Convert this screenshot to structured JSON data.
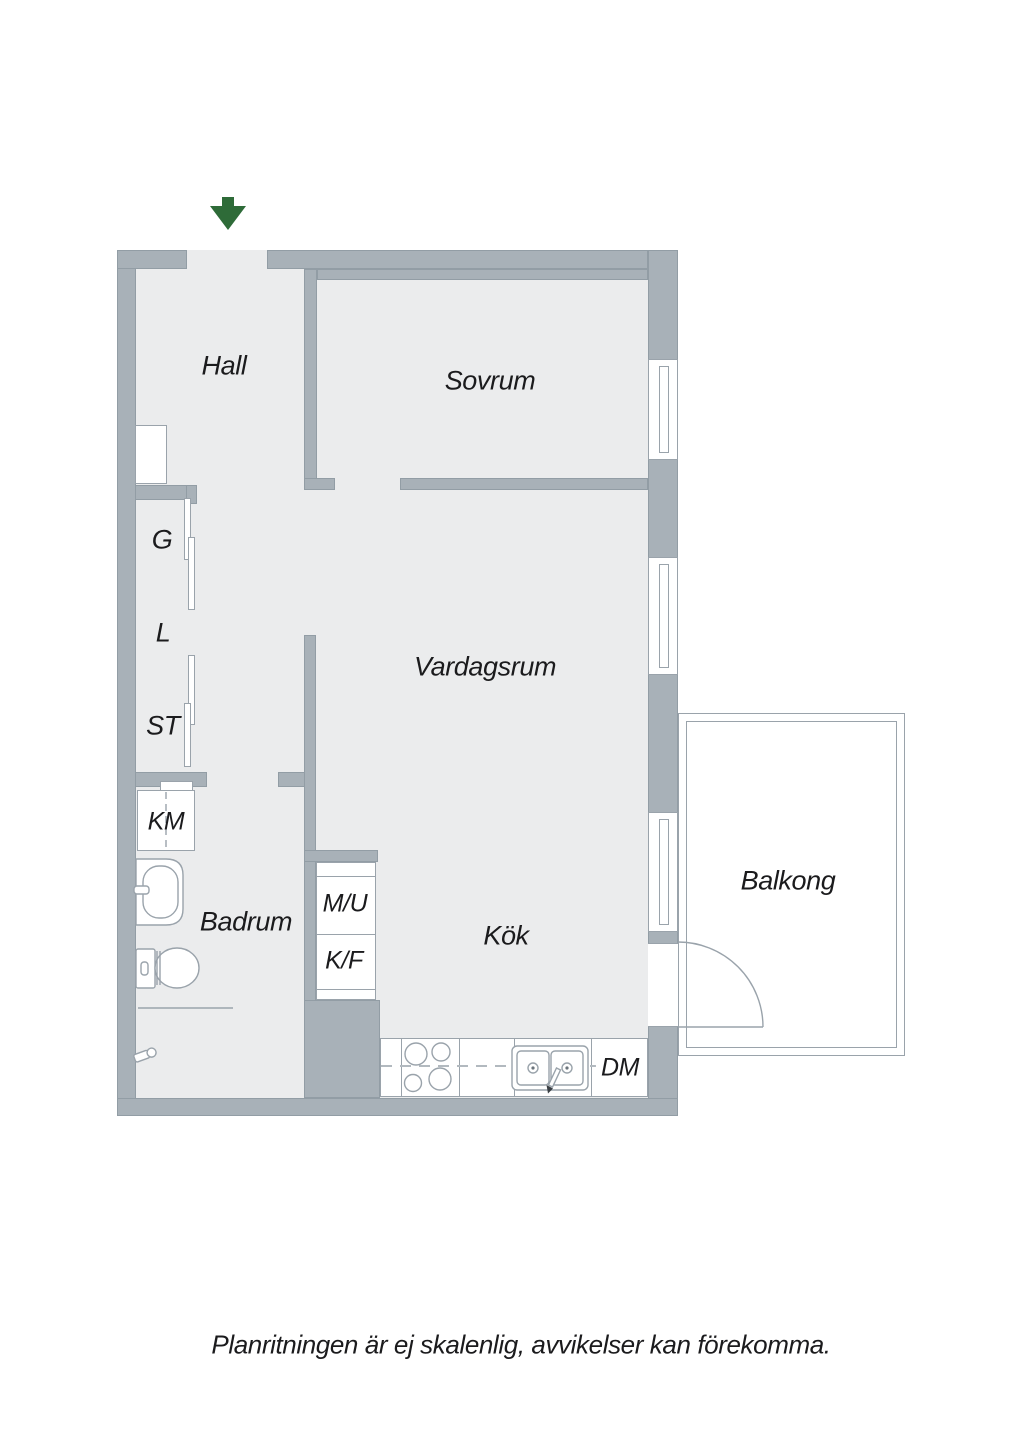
{
  "note": "Planritningen är ej skalenlig, avvikelser kan förekomma.",
  "rooms": {
    "hall": "Hall",
    "sovrum": "Sovrum",
    "vardagsrum": "Vardagsrum",
    "kok": "Kök",
    "badrum": "Badrum",
    "balkong": "Balkong"
  },
  "closets": {
    "garderob": "G",
    "linneskap": "L",
    "stadskap": "ST"
  },
  "appliances": {
    "tvattmaskin": "KM",
    "micro_ugn": "M/U",
    "kyl_frys": "K/F",
    "diskmaskin": "DM"
  },
  "icons": {
    "entrance_arrow": "green-down-arrow",
    "stove": "four-burner-hob-top-view",
    "kitchen_sink": "double-bowl-sink-with-faucet",
    "washbasin": "washbasin-top-view",
    "toilet": "toilet-top-view",
    "shower_drain": "shower-mixer-and-drain",
    "window": "double-glazing-line-window",
    "balcony_door": "door-swing-arc"
  },
  "colors": {
    "wall": "#a8b1b8",
    "wall_line": "#929da5",
    "floor": "#ebeced",
    "line": "#9aa3ab",
    "text": "#1b1b1d",
    "green": "#2e6b38",
    "dash": "#b2b9bf"
  }
}
